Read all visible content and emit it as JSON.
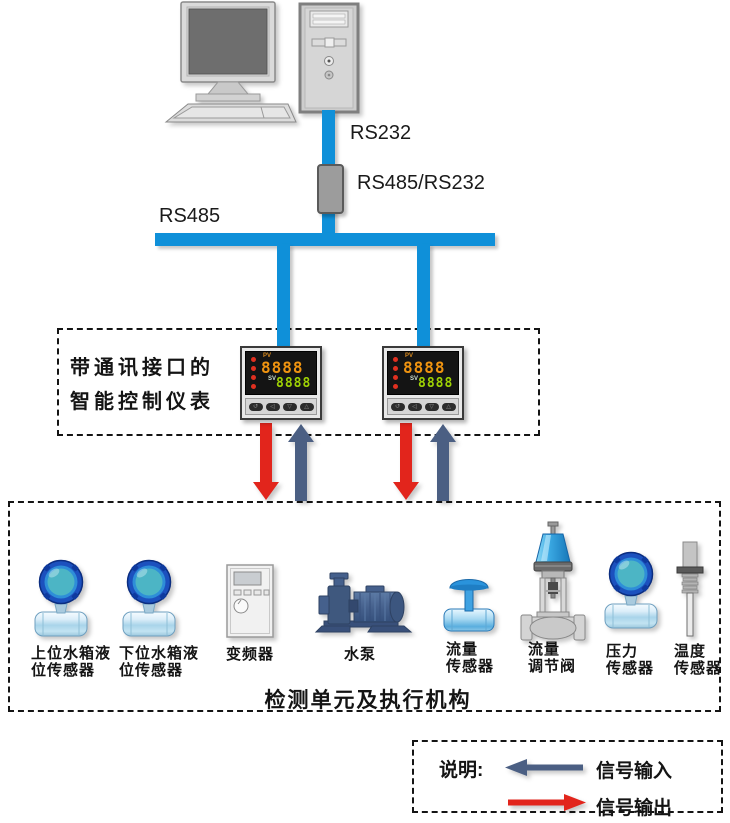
{
  "connections": {
    "rs232_label": "RS232",
    "converter_label": "RS485/RS232",
    "rs485_label": "RS485"
  },
  "controller_box": {
    "title": "带通讯接口的\n智能控制仪表"
  },
  "instrument": {
    "pv_label": "PV",
    "pv_value": "8888",
    "sv_label": "SV",
    "sv_value": "8888",
    "buttons": [
      "↺",
      "◁",
      "▽",
      "△"
    ]
  },
  "detection_box": {
    "caption": "检测单元及执行机构",
    "devices": [
      {
        "icon": "level-sensor",
        "label": "上位水箱液\n位传感器"
      },
      {
        "icon": "level-sensor",
        "label": "下位水箱液\n位传感器"
      },
      {
        "icon": "inverter",
        "label": "变频器"
      },
      {
        "icon": "water-pump",
        "label": "水泵"
      },
      {
        "icon": "flow-sensor",
        "label": "流量\n传感器"
      },
      {
        "icon": "flow-valve",
        "label": "流量\n调节阀"
      },
      {
        "icon": "pressure-sensor",
        "label": "压力\n传感器"
      },
      {
        "icon": "temperature-sensor",
        "label": "温度\n传感器"
      }
    ]
  },
  "legend": {
    "title": "说明:",
    "items": [
      {
        "label": "信号输入",
        "direction": "left",
        "color": "#4b5f83"
      },
      {
        "label": "信号输出",
        "direction": "right",
        "color": "#e2251c"
      }
    ]
  },
  "colors": {
    "bus": "#0f90d9",
    "signal_input": "#4b5f83",
    "signal_output": "#e2251c"
  }
}
